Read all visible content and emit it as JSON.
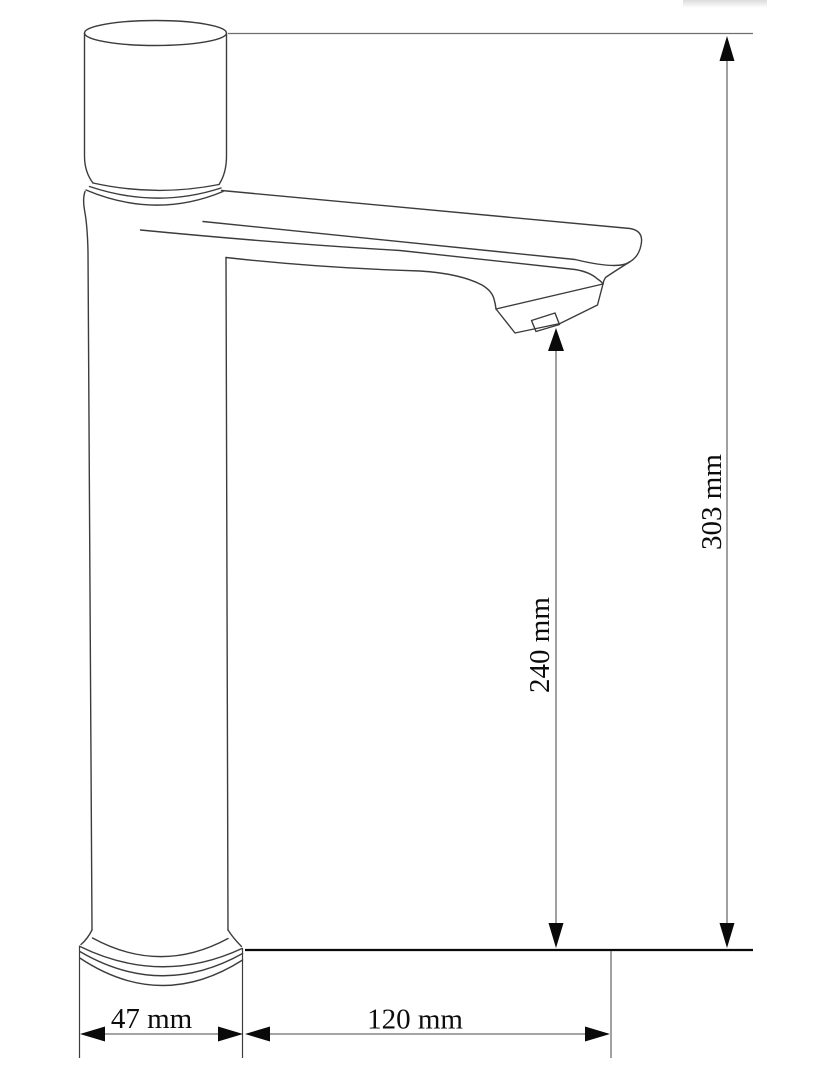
{
  "drawing": {
    "type": "technical-line-drawing",
    "subject": "tall single-handle basin faucet, side view with dimension lines"
  },
  "dimensions": {
    "base_width": {
      "label": "47 mm",
      "value_mm": 47,
      "unit": "mm",
      "orientation": "horizontal"
    },
    "spout_reach": {
      "label": "120 mm",
      "value_mm": 120,
      "unit": "mm",
      "orientation": "horizontal"
    },
    "outlet_height": {
      "label": "240 mm",
      "value_mm": 240,
      "unit": "mm",
      "orientation": "vertical"
    },
    "total_height": {
      "label": "303 mm",
      "value_mm": 303,
      "unit": "mm",
      "orientation": "vertical"
    }
  },
  "colors": {
    "background": "#ffffff",
    "outline": "#3c3c3c",
    "dimension_line": "#6e6e6e",
    "baseline": "#0a0a0a",
    "arrow": "#0a0a0a",
    "label_text": "#0c0c0c"
  }
}
